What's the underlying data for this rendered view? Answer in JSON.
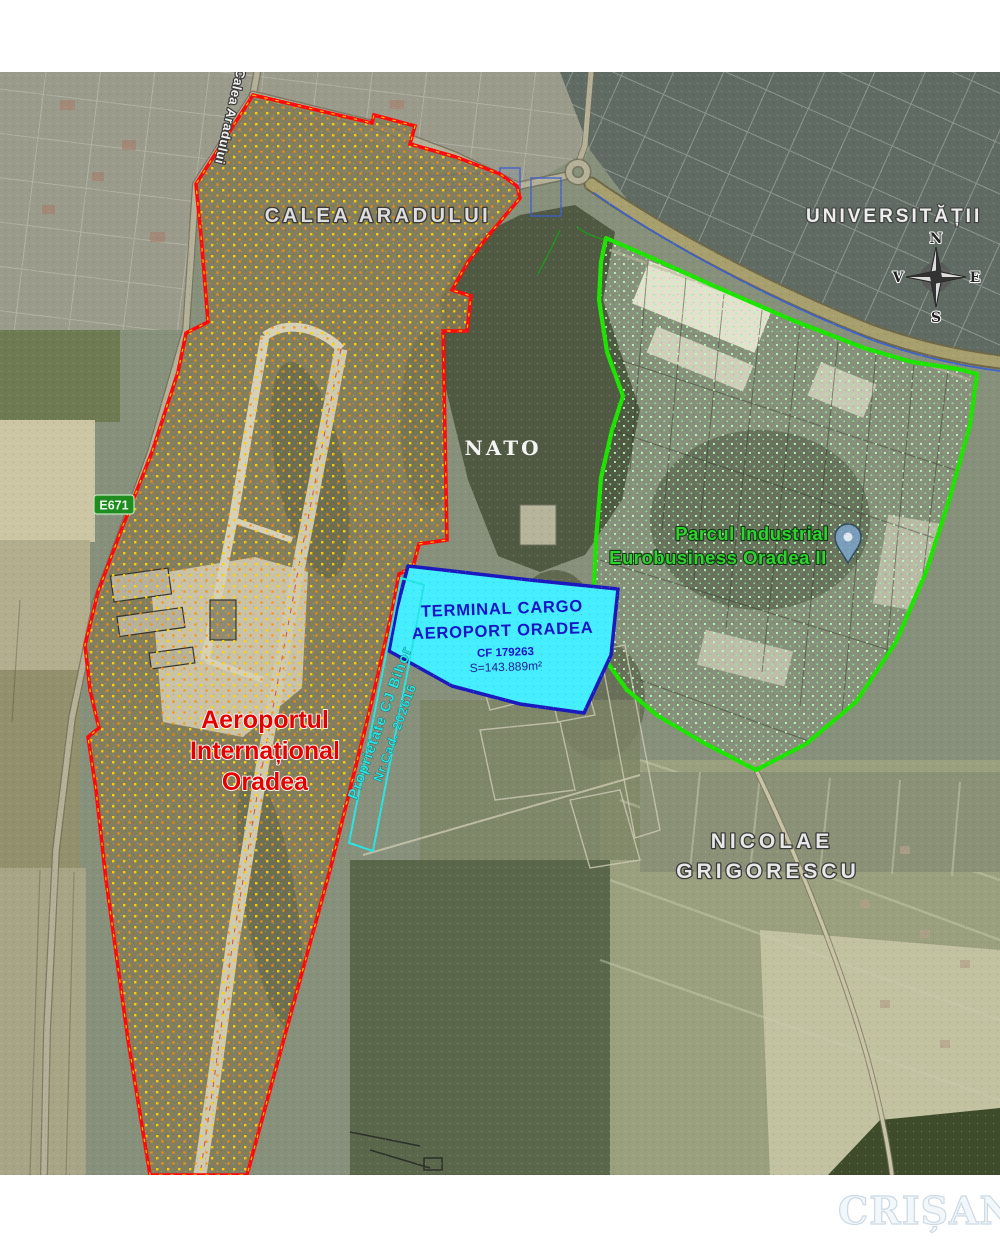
{
  "map": {
    "street_labels": {
      "calea_aradului_big": "CALEA ARADULUI",
      "calea_aradului_street": "Calea Aradului",
      "universitatii": "UNIVERSITĂȚII",
      "nicolae": "NICOLAE",
      "grigorescu": "GRIGORESCU",
      "nato": "NATO"
    },
    "zones": {
      "airport": {
        "line1": "Aeroportul",
        "line2": "Internațional",
        "line3": "Oradea",
        "boundary_color": "#ff0a0a",
        "label_color": "#e60000",
        "hatch_colors": [
          "#ffd200",
          "#ff9000"
        ]
      },
      "industrial_park": {
        "line1": "Parcul Industrial",
        "line2": "Eurobusiness Oradea II",
        "boundary_color": "#1de500",
        "label_color": "#2fd32f"
      },
      "cargo_terminal": {
        "line1": "TERMINAL CARGO",
        "line2": "AEROPORT ORADEA",
        "cf": "CF 179263",
        "area": "S=143.889m²",
        "fill": "#45eeff",
        "border": "#1a1abe",
        "label_color": "#1414c8"
      },
      "county_property": {
        "line1": "Proprietate CJ Bihor",
        "line2": "Nr.Cad. 202616",
        "outline_color": "#29e4e4"
      }
    },
    "road_badge": {
      "label": "E671",
      "bg": "#1f8c1f"
    },
    "compass": {
      "north": "N",
      "south": "S",
      "east": "E",
      "west": "V"
    }
  },
  "watermark": {
    "text": "CRIȘANA"
  }
}
